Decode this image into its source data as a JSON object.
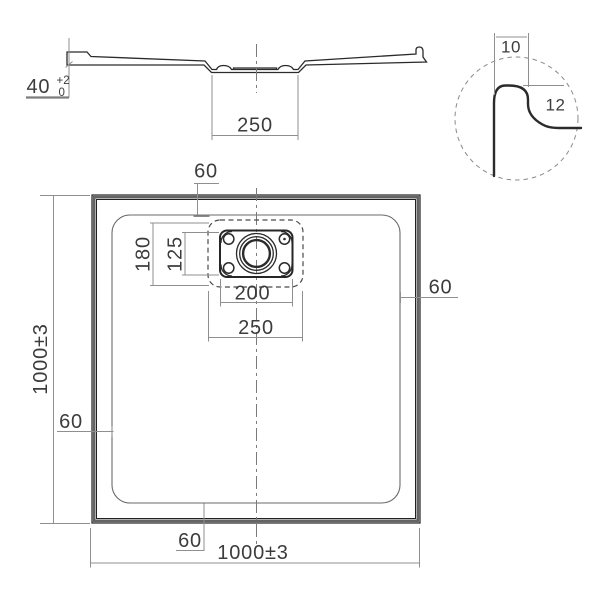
{
  "section_view": {
    "height_dim": {
      "nominal": "40",
      "tol_plus": "+2",
      "tol_minus": "0"
    },
    "recess_width_dim": "250"
  },
  "detail_view": {
    "lip_width_dim": "10",
    "lip_height_dim": "12"
  },
  "plan_view": {
    "overall_width_dim": "1000±3",
    "overall_height_dim": "1000±3",
    "border_offset_dims": {
      "top": "60",
      "right": "60",
      "bottom": "60",
      "left": "60"
    },
    "drain": {
      "recess_height_dim": "180",
      "flange_height_dim": "125",
      "flange_width_dim": "200",
      "recess_width_dim": "250"
    }
  },
  "colors": {
    "background": "#ffffff",
    "object_line": "#2b2b2b",
    "border_band": "#646464",
    "dim_line": "#8f8f8f",
    "text": "#3c3c3c"
  }
}
